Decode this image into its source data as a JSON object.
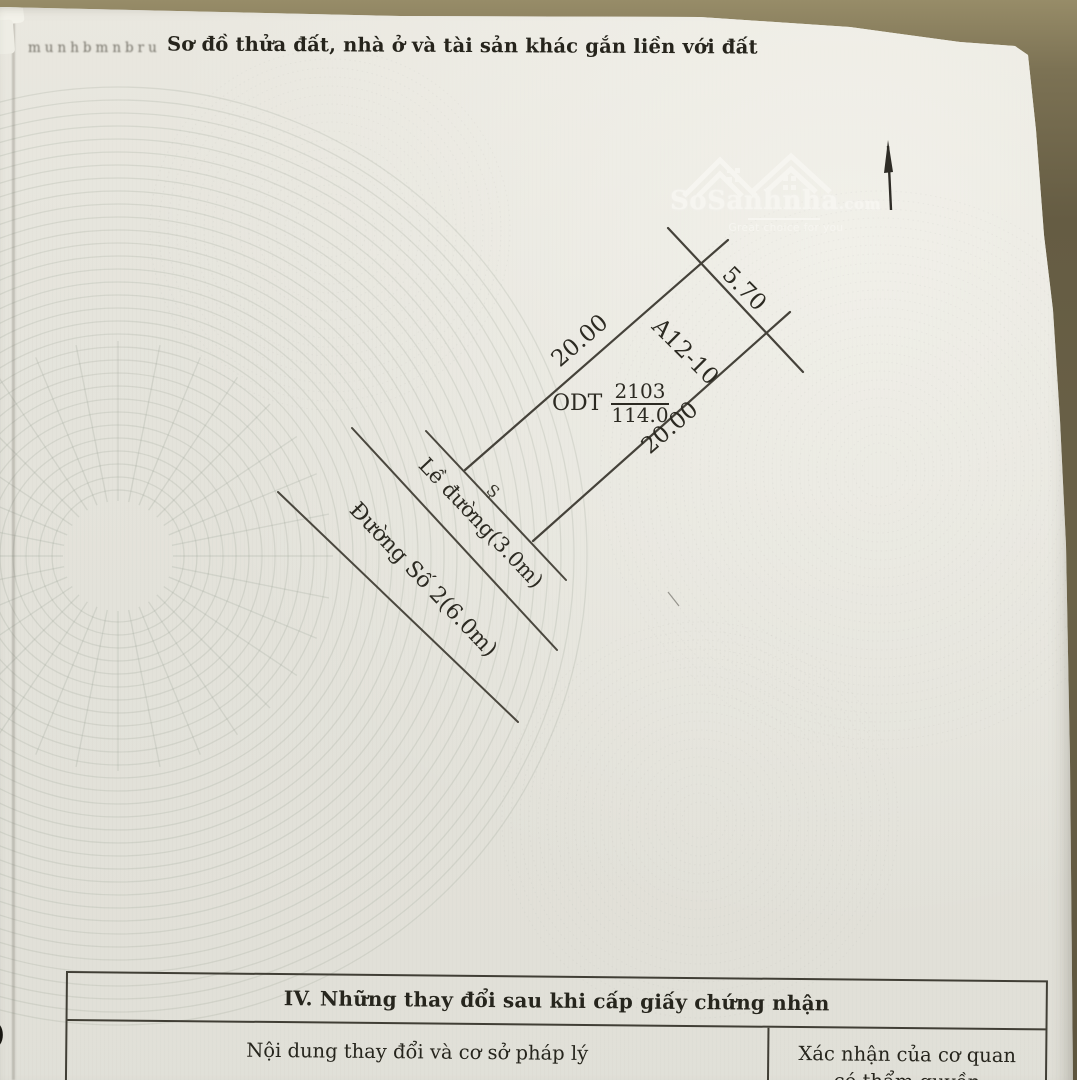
{
  "photo": {
    "edge_note": "munhbmnbru",
    "paper_edge_mark": ")"
  },
  "document": {
    "title": "Sơ đồ thửa đất, nhà ở và tài sản khác gắn liền với đất"
  },
  "logo": {
    "brand": "SoSanhnha",
    "suffix": ".com",
    "tagline": "Great choice for you"
  },
  "diagram": {
    "dim_left": "20.00",
    "dim_top": "5.70",
    "parcel_code": "A12-10",
    "land_use_code": "ODT",
    "parcel_number": "2103",
    "area_m2": "114.0",
    "dim_right": "20.00",
    "corner_mark": "Ş",
    "road_margin_label": "Lề đường(3.0m)",
    "road_label": "Đường Số 2(6.0m)"
  },
  "changes_table": {
    "title": "IV. Những thay đổi sau khi cấp giấy chứng nhận",
    "col_left": "Nội dung thay đổi và cơ sở pháp lý",
    "col_right_line1": "Xác nhận của cơ quan",
    "col_right_line2": "có thẩm quyền"
  }
}
